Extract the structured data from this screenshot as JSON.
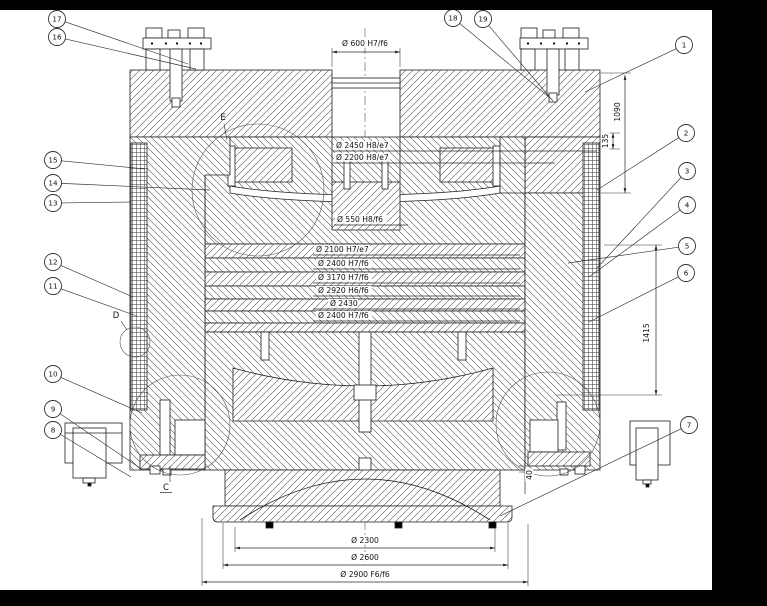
{
  "colors": {
    "paper": "#ffffff",
    "ink": "#1f1f1f",
    "band": "#000000",
    "hatch": "#4a4a4a"
  },
  "drawing": {
    "kind": "hydraulic-press-cylinder-cross-section",
    "center_dims": [
      {
        "text": "Ø 600 H7/f6",
        "x": 365,
        "y": 46,
        "anchor": "middle",
        "line": {
          "x1": 332,
          "x2": 400,
          "y": 52,
          "arrows": true
        },
        "ext": [
          [
            332,
            48,
            332,
            67
          ],
          [
            400,
            48,
            400,
            67
          ]
        ]
      },
      {
        "text": "Ø 2450 H8/e7",
        "x": 336,
        "y": 148,
        "anchor": "start",
        "line": {
          "x1": 333,
          "x2": 597,
          "y": 151
        }
      },
      {
        "text": "Ø 2200 H8/e7",
        "x": 336,
        "y": 160,
        "anchor": "start",
        "line": {
          "x1": 333,
          "x2": 555,
          "y": 163
        }
      },
      {
        "text": "Ø 550 H8/f6",
        "x": 337,
        "y": 222,
        "anchor": "start",
        "line": {
          "x1": 334,
          "x2": 408,
          "y": 225
        }
      },
      {
        "text": "Ø 2100 H7/e7",
        "x": 316,
        "y": 252,
        "anchor": "start",
        "line": {
          "x1": 313,
          "x2": 520,
          "y": 255
        }
      },
      {
        "text": "Ø 2400 H7/f6",
        "x": 318,
        "y": 266,
        "anchor": "start",
        "line": {
          "x1": 313,
          "x2": 520,
          "y": 269
        }
      },
      {
        "text": "Ø 3170 H7/f6",
        "x": 318,
        "y": 280,
        "anchor": "start",
        "line": {
          "x1": 313,
          "x2": 520,
          "y": 283
        }
      },
      {
        "text": "Ø 2920 H6/f6",
        "x": 318,
        "y": 293,
        "anchor": "start",
        "line": {
          "x1": 313,
          "x2": 520,
          "y": 296
        }
      },
      {
        "text": "Ø 2430",
        "x": 330,
        "y": 306,
        "anchor": "start",
        "line": {
          "x1": 313,
          "x2": 520,
          "y": 309
        }
      },
      {
        "text": "Ø 2400 H7/f6",
        "x": 318,
        "y": 318,
        "anchor": "start",
        "line": {
          "x1": 313,
          "x2": 520,
          "y": 321
        }
      },
      {
        "text": "Ø 2300",
        "x": 365,
        "y": 543,
        "anchor": "middle",
        "line": {
          "x1": 235,
          "x2": 495,
          "y": 548,
          "arrows": true
        },
        "ext": [
          [
            235,
            527,
            235,
            552
          ],
          [
            495,
            527,
            495,
            552
          ]
        ]
      },
      {
        "text": "Ø 2600",
        "x": 365,
        "y": 560,
        "anchor": "middle",
        "line": {
          "x1": 223,
          "x2": 508,
          "y": 565,
          "arrows": true
        },
        "ext": [
          [
            223,
            523,
            223,
            569
          ],
          [
            508,
            523,
            508,
            569
          ]
        ]
      },
      {
        "text": "Ø 2900 F6/f6",
        "x": 365,
        "y": 577,
        "anchor": "middle",
        "line": {
          "x1": 202,
          "x2": 528,
          "y": 582,
          "arrows": true
        },
        "ext": [
          [
            202,
            518,
            202,
            586
          ],
          [
            528,
            524,
            528,
            586
          ]
        ]
      }
    ],
    "side_dims": [
      {
        "text": "1090",
        "x": 620,
        "y": 112,
        "rot": -90,
        "line": {
          "x1": 625,
          "y1": 75,
          "x2": 625,
          "y2": 193,
          "arrows": true
        },
        "ext": [
          [
            601,
            73,
            631,
            73
          ],
          [
            601,
            193,
            631,
            193
          ]
        ]
      },
      {
        "text": "135",
        "x": 608,
        "y": 141,
        "rot": -90,
        "line": {
          "x1": 613,
          "y1": 133,
          "x2": 613,
          "y2": 149,
          "arrows": true
        },
        "ext": [
          [
            601,
            133,
            620,
            133
          ],
          [
            601,
            149,
            620,
            149
          ]
        ]
      },
      {
        "text": "1415",
        "x": 649,
        "y": 333,
        "rot": -90,
        "line": {
          "x1": 656,
          "y1": 245,
          "x2": 656,
          "y2": 395,
          "arrows": true
        },
        "ext": [
          [
            604,
            245,
            662,
            245
          ],
          [
            556,
            395,
            662,
            395
          ]
        ]
      },
      {
        "text": "40",
        "x": 532,
        "y": 475,
        "rot": -90,
        "line": {
          "x1": 525,
          "y1": 456,
          "x2": 525,
          "y2": 494,
          "arrows": false
        },
        "ext": [
          [
            519,
            466,
            531,
            466
          ],
          [
            519,
            472,
            531,
            472
          ]
        ]
      }
    ],
    "callouts": [
      {
        "n": "1",
        "cx": 684,
        "cy": 45,
        "tx": 585,
        "ty": 92
      },
      {
        "n": "2",
        "cx": 686,
        "cy": 133,
        "tx": 597,
        "ty": 190
      },
      {
        "n": "3",
        "cx": 687,
        "cy": 171,
        "tx": 597,
        "ty": 268
      },
      {
        "n": "4",
        "cx": 687,
        "cy": 205,
        "tx": 589,
        "ty": 277
      },
      {
        "n": "5",
        "cx": 687,
        "cy": 246,
        "tx": 568,
        "ty": 263
      },
      {
        "n": "6",
        "cx": 686,
        "cy": 273,
        "tx": 589,
        "ty": 322
      },
      {
        "n": "7",
        "cx": 689,
        "cy": 425,
        "tx": 500,
        "ty": 516
      },
      {
        "n": "8",
        "cx": 53,
        "cy": 430,
        "tx": 131,
        "ty": 477
      },
      {
        "n": "9",
        "cx": 53,
        "cy": 409,
        "tx": 140,
        "ty": 468
      },
      {
        "n": "10",
        "cx": 53,
        "cy": 374,
        "tx": 142,
        "ty": 413
      },
      {
        "n": "11",
        "cx": 53,
        "cy": 286,
        "tx": 137,
        "ty": 316
      },
      {
        "n": "12",
        "cx": 53,
        "cy": 262,
        "tx": 133,
        "ty": 297
      },
      {
        "n": "13",
        "cx": 53,
        "cy": 203,
        "tx": 131,
        "ty": 202
      },
      {
        "n": "14",
        "cx": 53,
        "cy": 183,
        "tx": 210,
        "ty": 190
      },
      {
        "n": "15",
        "cx": 53,
        "cy": 160,
        "tx": 145,
        "ty": 169
      },
      {
        "n": "16",
        "cx": 57,
        "cy": 37,
        "tx": 196,
        "ty": 69
      },
      {
        "n": "17",
        "cx": 57,
        "cy": 19,
        "tx": 188,
        "ty": 64
      },
      {
        "n": "18",
        "cx": 453,
        "cy": 18,
        "tx": 549,
        "ty": 97
      },
      {
        "n": "19",
        "cx": 483,
        "cy": 19,
        "tx": 553,
        "ty": 101
      }
    ],
    "detail_markers": [
      {
        "label": "E",
        "x": 223,
        "y": 120,
        "leader": [
          224,
          124,
          227,
          140
        ]
      },
      {
        "label": "D",
        "x": 116,
        "y": 318,
        "leader": [
          121,
          321,
          127,
          330
        ]
      },
      {
        "label": "C",
        "x": 166,
        "y": 490,
        "underline": true,
        "leader": [
          170,
          466,
          170,
          482
        ]
      }
    ]
  }
}
